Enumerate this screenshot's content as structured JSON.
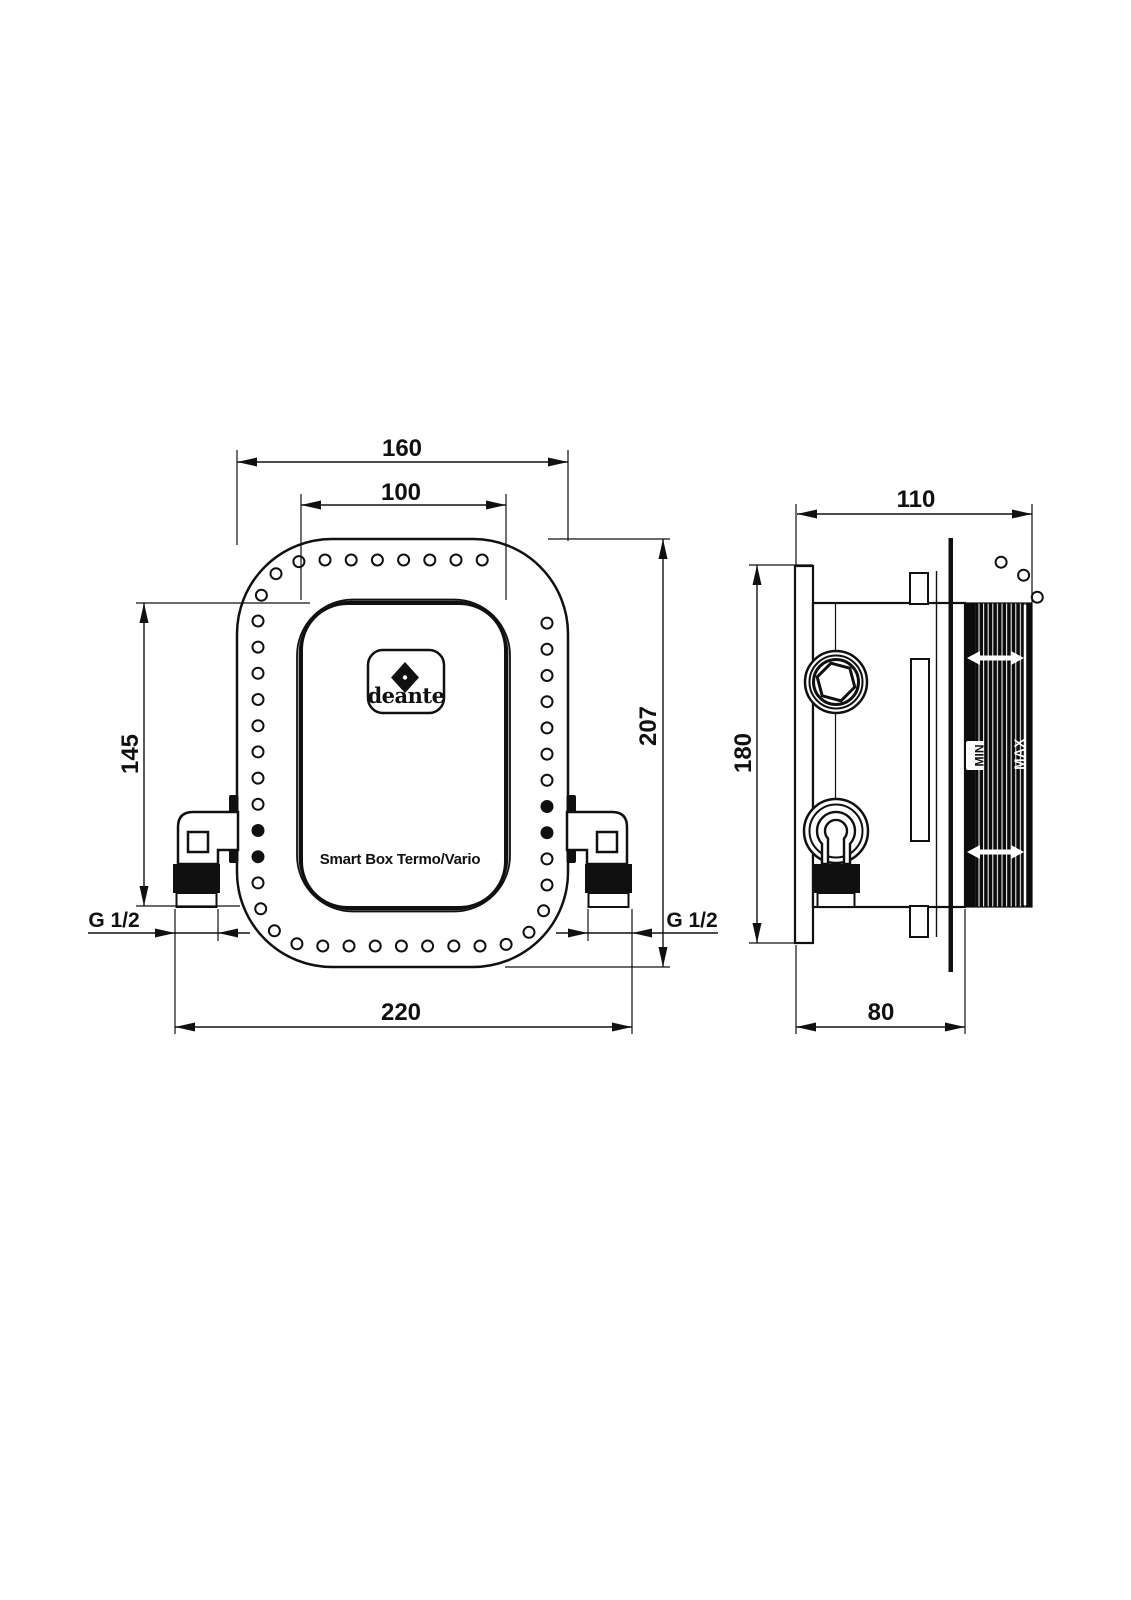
{
  "drawing": {
    "brand_logo": "deante",
    "product_label": "Smart Box Termo/Vario",
    "front_view": {
      "dim_width_outer": "160",
      "dim_width_panel": "100",
      "dim_height_overall": "207",
      "dim_panel_to_outlet": "145",
      "dim_width_across_connectors": "220",
      "thread_label_left": "G 1/2",
      "thread_label_right": "G 1/2"
    },
    "side_view": {
      "dim_depth_overall": "110",
      "dim_height_plate": "180",
      "dim_depth_box": "80",
      "depth_min_label": "MIN",
      "depth_max_label": "MAX"
    },
    "colors": {
      "line": "#101010",
      "background": "#ffffff"
    }
  }
}
